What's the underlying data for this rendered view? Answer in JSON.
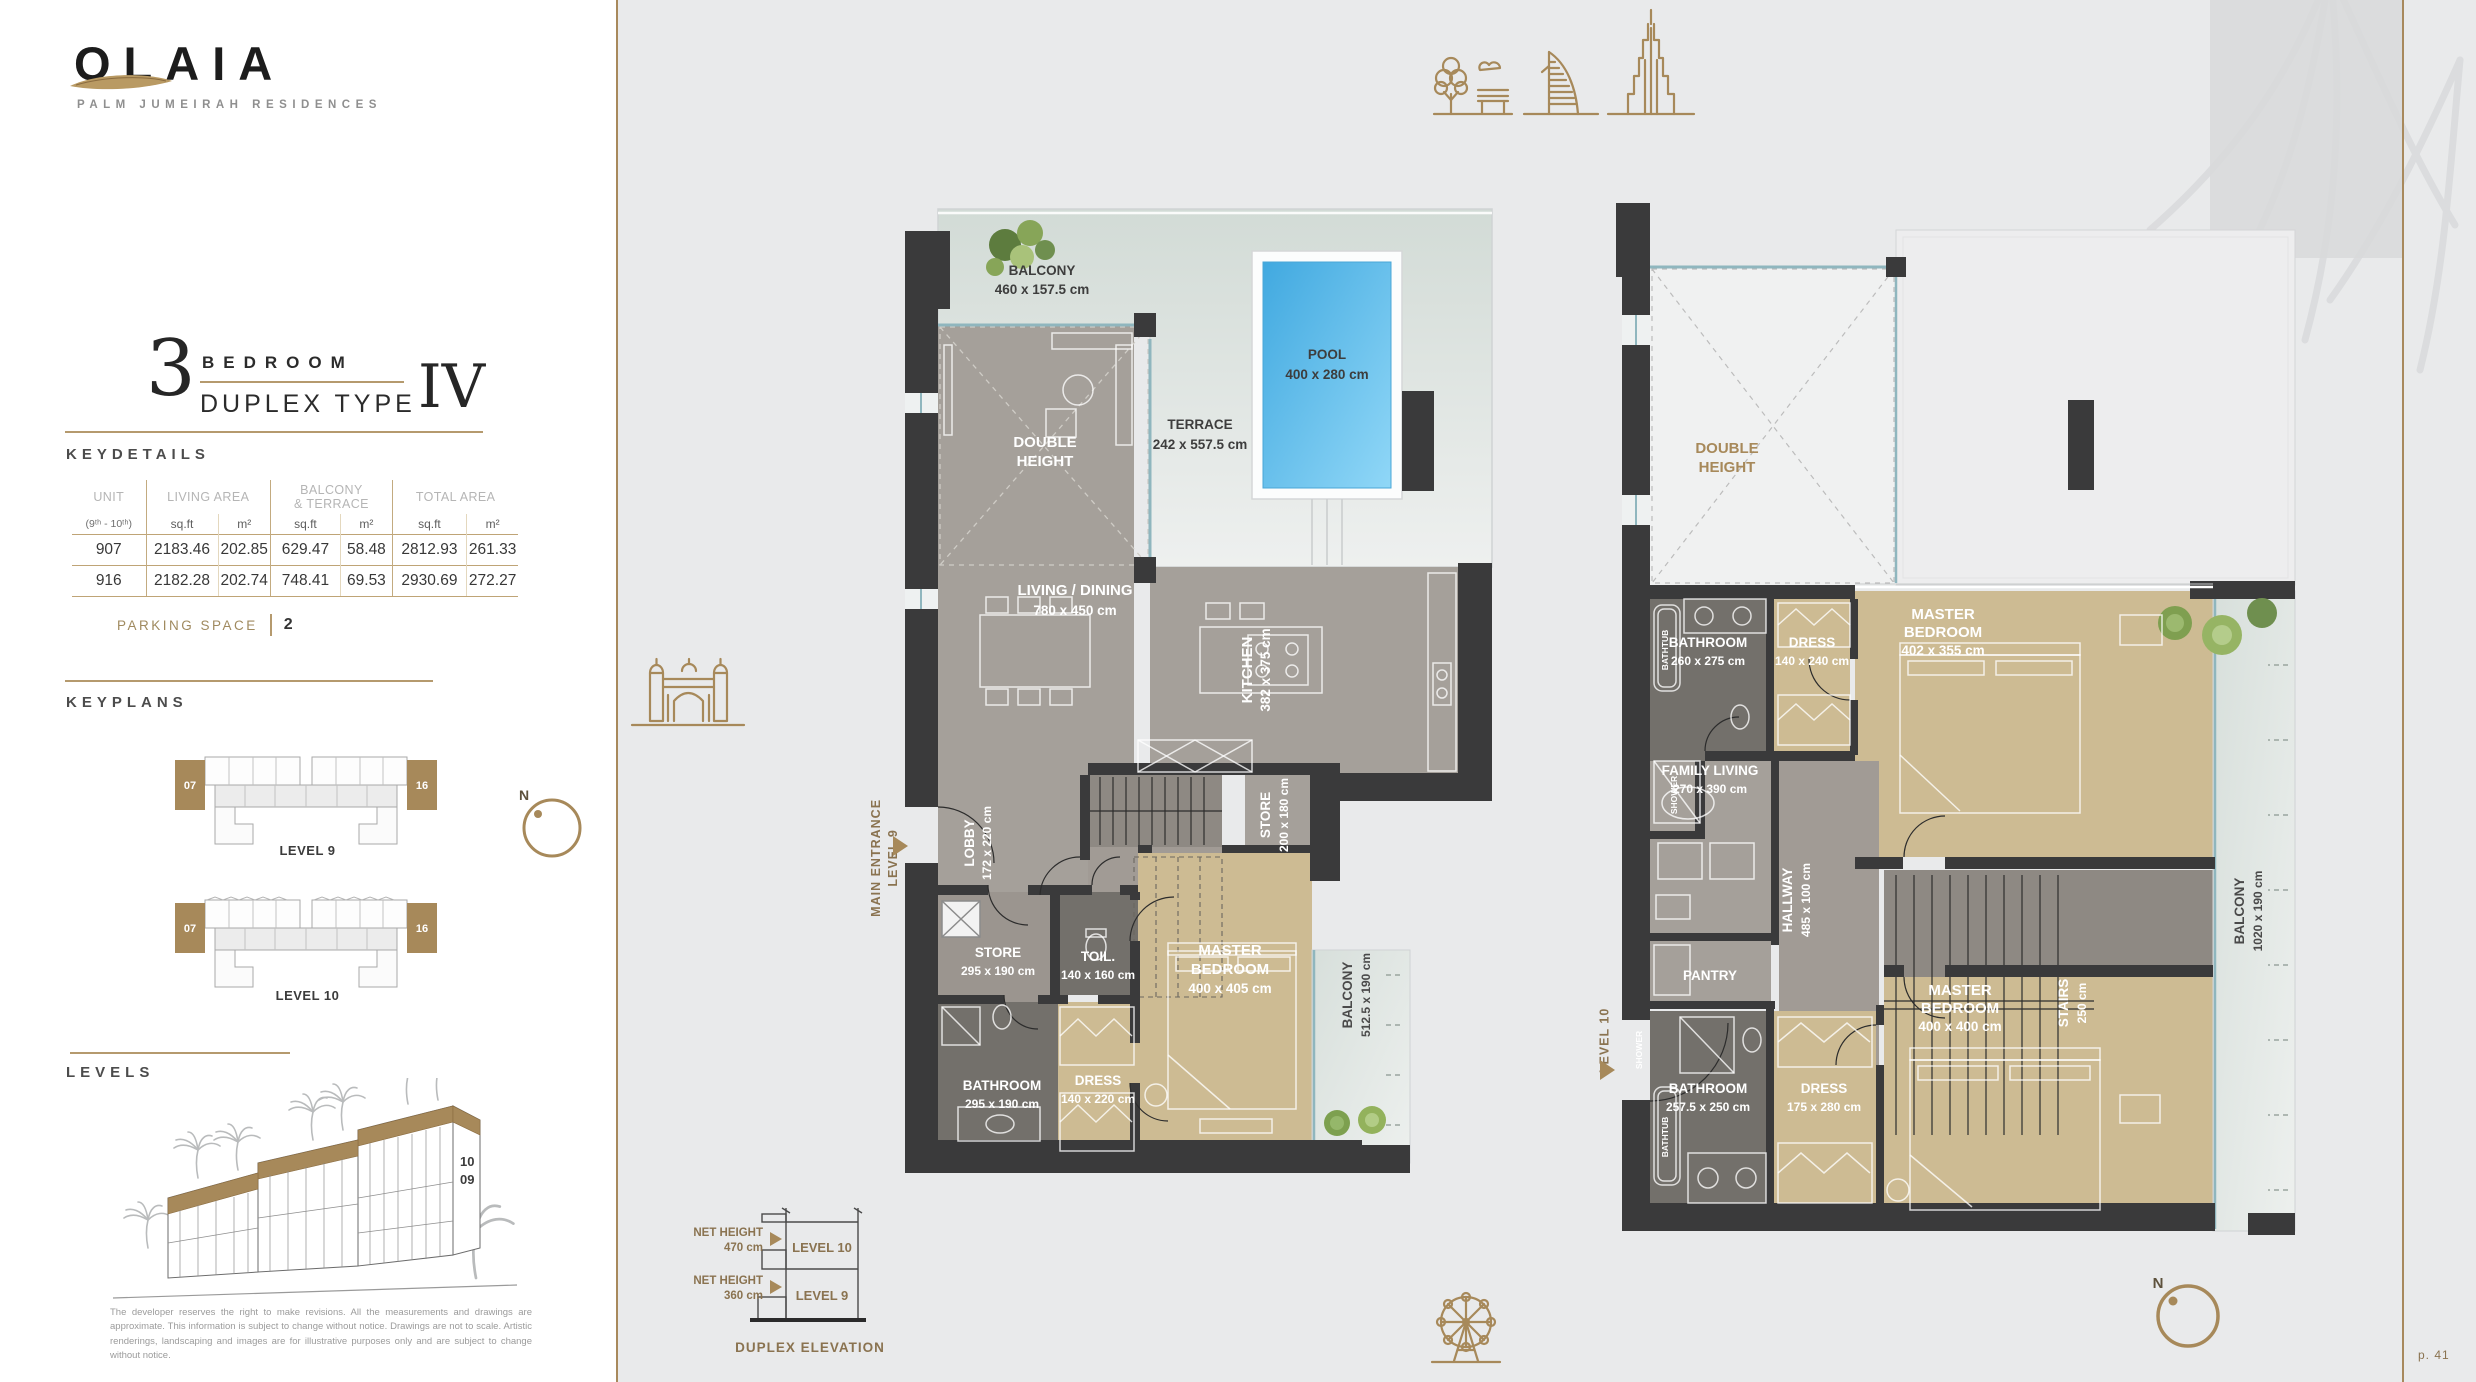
{
  "brand": {
    "logo": "OLAIA",
    "tagline": "PALM JUMEIRAH RESIDENCES"
  },
  "unit_header": {
    "number": "3",
    "bedroom": "BEDROOM",
    "duplex": "DUPLEX TYPE",
    "numeral": "IV"
  },
  "key_details": {
    "heading": "KEYDETAILS",
    "table": {
      "unit_title": "UNIT",
      "unit_sub": "(9ᵗʰ - 10ᵗʰ)",
      "living_title": "LIVING AREA",
      "balcony_title_1": "BALCONY",
      "balcony_title_2": "& TERRACE",
      "total_title": "TOTAL AREA",
      "sqft": "sq.ft",
      "m2": "m²",
      "rows": [
        [
          "907",
          "2183.46",
          "202.85",
          "629.47",
          "58.48",
          "2812.93",
          "261.33"
        ],
        [
          "916",
          "2182.28",
          "202.74",
          "748.41",
          "69.53",
          "2930.69",
          "272.27"
        ]
      ]
    },
    "parking_label": "PARKING SPACE",
    "parking_value": "2"
  },
  "keyplans": {
    "heading": "KEYPLANS",
    "level9": "LEVEL 9",
    "level10": "LEVEL 10",
    "unit_left": "07",
    "unit_right": "16",
    "north": "N"
  },
  "levels": {
    "heading": "LEVELS",
    "floor_top": "10",
    "floor_bottom": "09",
    "disclaimer": "The developer reserves the right to make revisions. All the measurements and drawings are approximate. This information is subject to change without notice. Drawings are not to scale. Artistic renderings, landscaping and images are for illustrative purposes only and are subject to change without notice."
  },
  "elevation": {
    "net_height": "NET HEIGHT",
    "h470": "470 cm",
    "h360": "360 cm",
    "level10": "LEVEL 10",
    "level9": "LEVEL 9",
    "caption": "DUPLEX ELEVATION"
  },
  "page_number": "p. 41",
  "l9": {
    "entrance1": "MAIN ENTRANCE",
    "entrance2": "LEVEL 9",
    "balcony_top": {
      "name": "BALCONY",
      "dims": "460 x 157.5 cm"
    },
    "terrace": {
      "name": "TERRACE",
      "dims": "242 x 557.5 cm"
    },
    "pool": {
      "name": "POOL",
      "dims": "400 x 280 cm"
    },
    "double_height": {
      "name1": "DOUBLE",
      "name2": "HEIGHT"
    },
    "living": {
      "name": "LIVING / DINING",
      "dims": "780 x 450 cm"
    },
    "kitchen": {
      "name": "KITCHEN",
      "dims": "382 x 375 cm"
    },
    "lobby": {
      "name": "LOBBY",
      "dims": "172 x 220 cm"
    },
    "store_upper": {
      "name": "STORE",
      "dims": "200 x 180 cm"
    },
    "store": {
      "name": "STORE",
      "dims": "295 x 190 cm"
    },
    "toilet": {
      "name": "TOIL.",
      "dims": "140 x 160 cm"
    },
    "master": {
      "name1": "MASTER",
      "name2": "BEDROOM",
      "dims": "400 x 405 cm"
    },
    "bathroom": {
      "name": "BATHROOM",
      "dims": "295 x 190 cm"
    },
    "dress": {
      "name": "DRESS",
      "dims": "140 x 220 cm"
    },
    "balcony_side": {
      "name": "BALCONY",
      "dims": "512.5 x 190 cm"
    }
  },
  "l10": {
    "level_label": "LEVEL 10",
    "double_height": {
      "name1": "DOUBLE",
      "name2": "HEIGHT"
    },
    "bathroom_upper": {
      "name": "BATHROOM",
      "dims": "260 x 275 cm"
    },
    "dress_upper": {
      "name": "DRESS",
      "dims": "140 x 240 cm"
    },
    "master_upper": {
      "name1": "MASTER",
      "name2": "BEDROOM",
      "dims": "402 x 355 cm"
    },
    "family": {
      "name": "FAMILY LIVING",
      "dims": "270 x 390 cm"
    },
    "hallway": {
      "name": "HALLWAY",
      "dims": "485 x 100 cm"
    },
    "stairs": {
      "name": "STAIRS",
      "dims": "250 cm"
    },
    "pantry": {
      "name": "PANTRY"
    },
    "bathroom_lower": {
      "name": "BATHROOM",
      "dims": "257.5 x 250 cm"
    },
    "dress_lower": {
      "name": "DRESS",
      "dims": "175 x 280 cm"
    },
    "master_lower": {
      "name1": "MASTER",
      "name2": "BEDROOM",
      "dims": "400 x 400 cm"
    },
    "balcony": {
      "name": "BALCONY",
      "dims": "1020 x 190 cm"
    },
    "bathtub": "BATHTUB",
    "shower": "SHOWER"
  }
}
